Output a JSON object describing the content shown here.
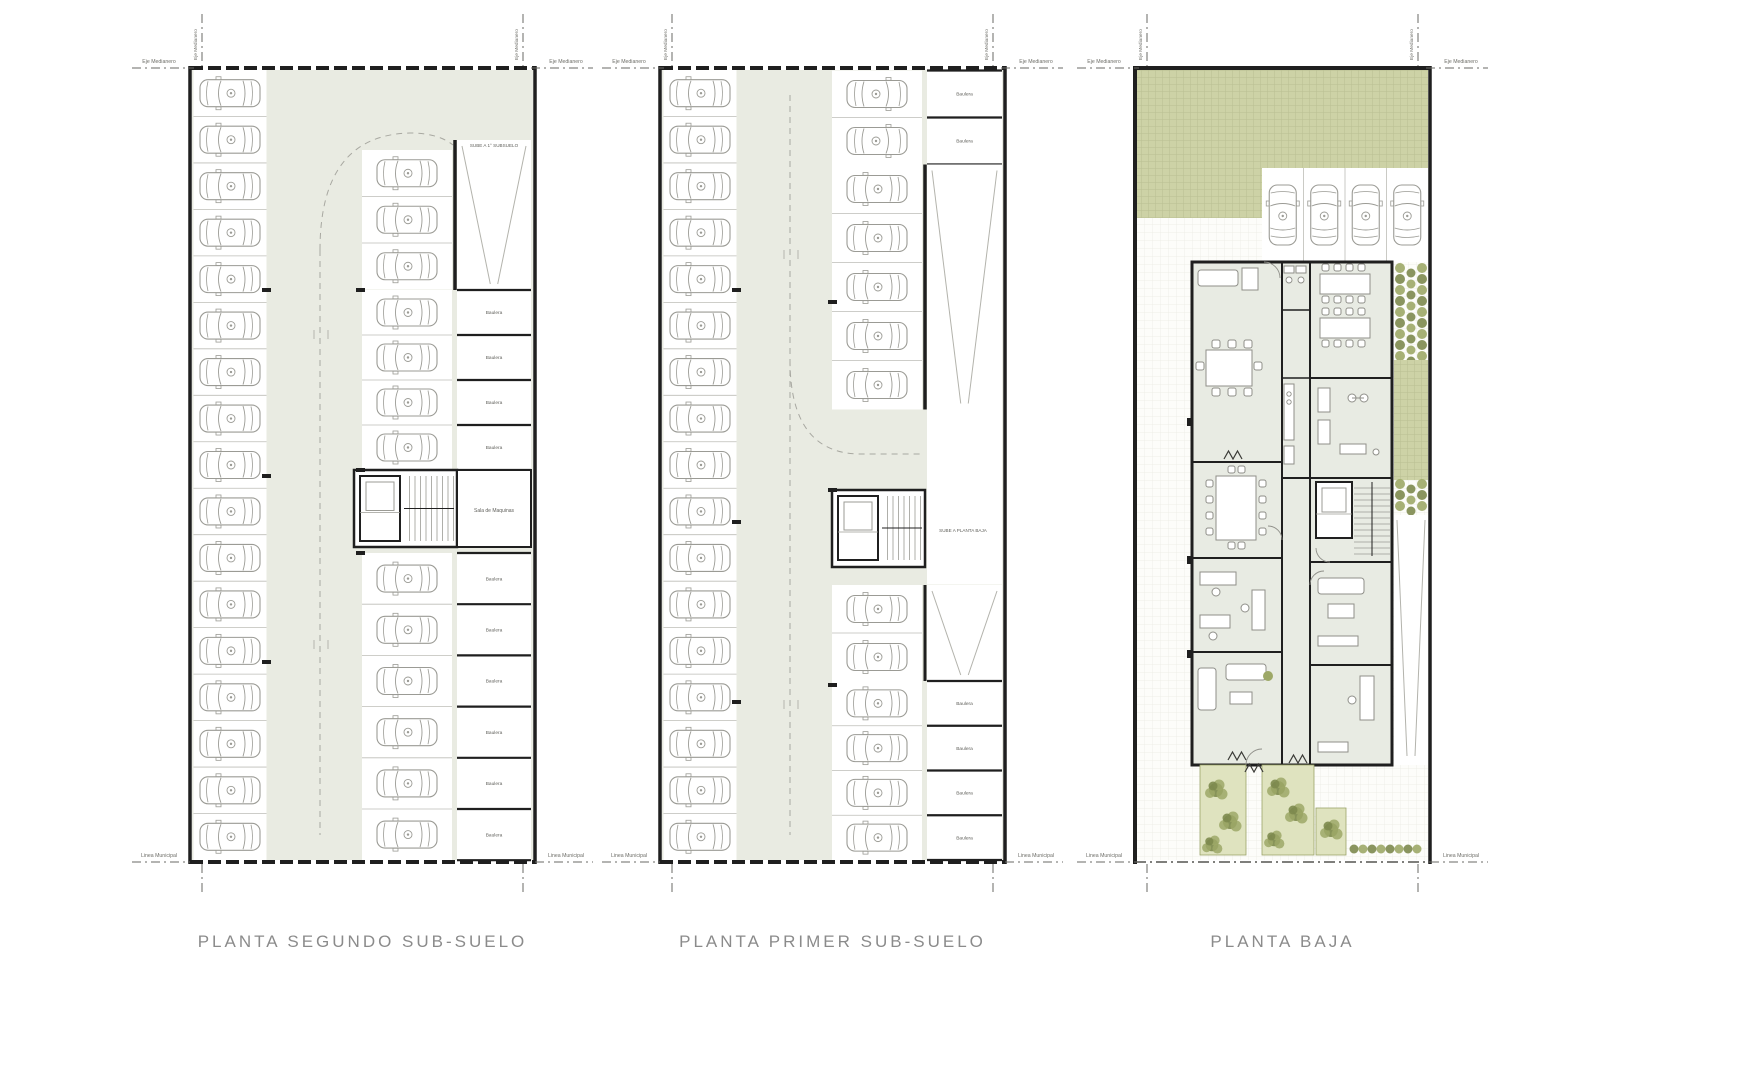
{
  "sheet": {
    "background": "#ffffff"
  },
  "colors": {
    "wall": "#1f1f1f",
    "aisle": "#e9ebe2",
    "stall_line": "#bdbdb7",
    "car_line": "#9b9b95",
    "dash_guide": "#a8a8a1",
    "ramp_line": "#b3b3ac",
    "garden_fill": "#cdd2a6",
    "garden_grid": "#b9bf92",
    "pave_line": "#ebebe2",
    "hedge_dark": "#7d8a4e",
    "hedge_light": "#9da867",
    "planter_bg": "#dfe3bf",
    "room_fill": "#e8ebe3",
    "furniture_line": "#8f8f89",
    "title": "#8b8b8b",
    "tiny_text": "#5f5f5a",
    "boundary_text": "#6e6e68",
    "boundary_line": "#6a6a64"
  },
  "labels": {
    "eje_medianero": "Eje Medianero",
    "linea_municipal": "Linea Municipal",
    "baulera": "Baulera"
  },
  "plans": [
    {
      "id": "planta-segundo-subsuelo",
      "title": "PLANTA SEGUNDO SUB-SUELO",
      "parking_spaces": {
        "left_column": 17,
        "right_top": 3,
        "right_middle": 4,
        "right_bottom": 6
      },
      "storage_rooms": {
        "upper": 4,
        "lower": 6
      },
      "annotations": {
        "ramp": "SUBE A 1° SUBSUELO",
        "machine_room": "Sala de Maquinas"
      }
    },
    {
      "id": "planta-primer-subsuelo",
      "title": "PLANTA PRIMER SUB-SUELO",
      "parking_spaces": {
        "left_column": 17,
        "right_top": 2,
        "right_middle": 5,
        "right_lower": 2,
        "right_bottom": 4
      },
      "storage_rooms": {
        "upper": 2,
        "lower": 4
      },
      "annotations": {
        "ramp_down": "BAJA A 2° SUBSUELO",
        "ramp_up": "SUBE A PLANTA BAJA"
      }
    },
    {
      "id": "planta-baja",
      "title": "PLANTA BAJA",
      "parking_spaces": {
        "driveway": 4
      }
    }
  ]
}
